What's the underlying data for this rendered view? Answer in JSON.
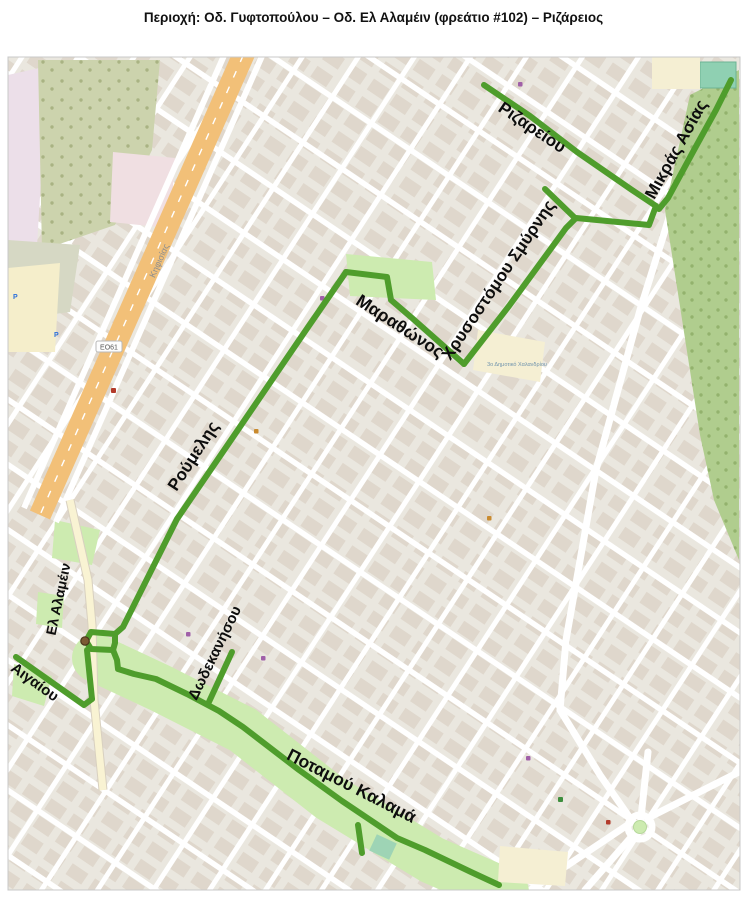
{
  "title": "Περιοχή: Οδ. Γυφτοπούλου – Οδ. Ελ Αλαμέιν (φρεάτιο #102) – Ριζάρειος",
  "map": {
    "route_color": "#4f9d2c",
    "park_color": "#cdebb0",
    "forest_color": "#b0cd8e",
    "highway_color": "#f2c078",
    "street_labels": [
      {
        "text": "Ριζαρείου"
      },
      {
        "text": "Μικράς Ασίας"
      },
      {
        "text": "Χρυσοστόμου Σμύρνης"
      },
      {
        "text": "Μαραθώνος"
      },
      {
        "text": "Ρούμελης"
      },
      {
        "text": "Ελ Αλαμέιν"
      },
      {
        "text": "Αιγαίου"
      },
      {
        "text": "Δωδεκανήσου"
      },
      {
        "text": "Ποταμού Καλαμά"
      }
    ],
    "road_ref_badge": "ΕΟ61",
    "highway_label": "Κηφισίας",
    "school_label": "3ο Δημοτικό Χαλανδρίου",
    "parking_label": "P",
    "marker": {
      "name": "manhole-102",
      "color": "#7b5a33"
    }
  }
}
